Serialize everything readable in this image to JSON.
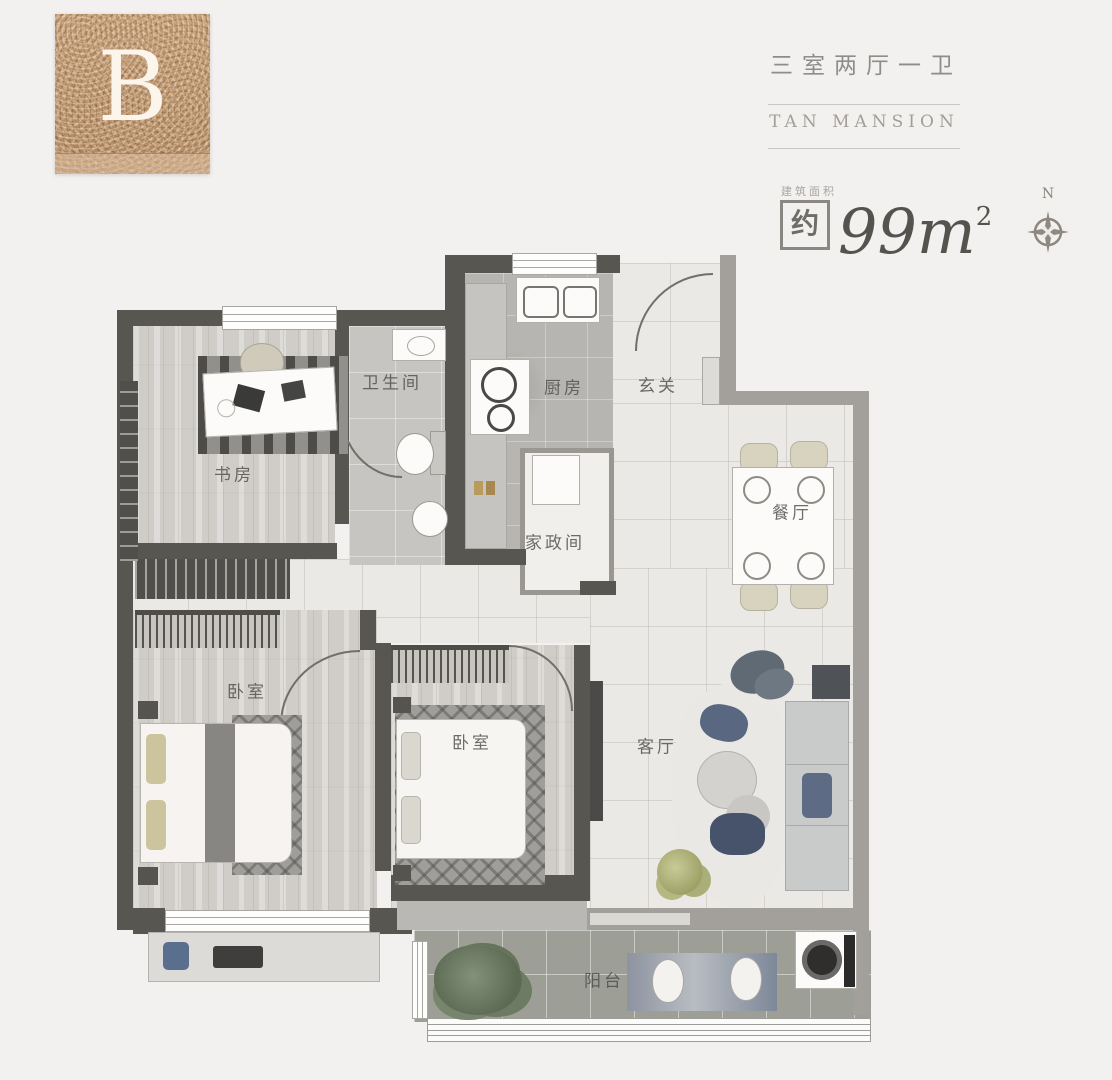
{
  "unit": {
    "letter": "B"
  },
  "header": {
    "title_cn": "三室两厅一卫",
    "brand": "TAN MANSION",
    "area_label": "建筑面积",
    "area_approx": "约",
    "area_value": "99",
    "area_unit": "m",
    "area_sup": "2",
    "compass_n": "N"
  },
  "rooms": {
    "study": "书房",
    "bathroom": "卫生间",
    "kitchen": "厨房",
    "entry": "玄关",
    "utility": "家政间",
    "dining": "餐厅",
    "bedroom_left": "卧室",
    "bedroom_mid": "卧室",
    "living": "客厅",
    "balcony": "阳台"
  },
  "colors": {
    "bronze": "#b98f66",
    "wall_dark": "#585651",
    "wall_mid": "#a3a09c",
    "background": "#f2f1ef",
    "text_gray": "#8f8d89"
  }
}
